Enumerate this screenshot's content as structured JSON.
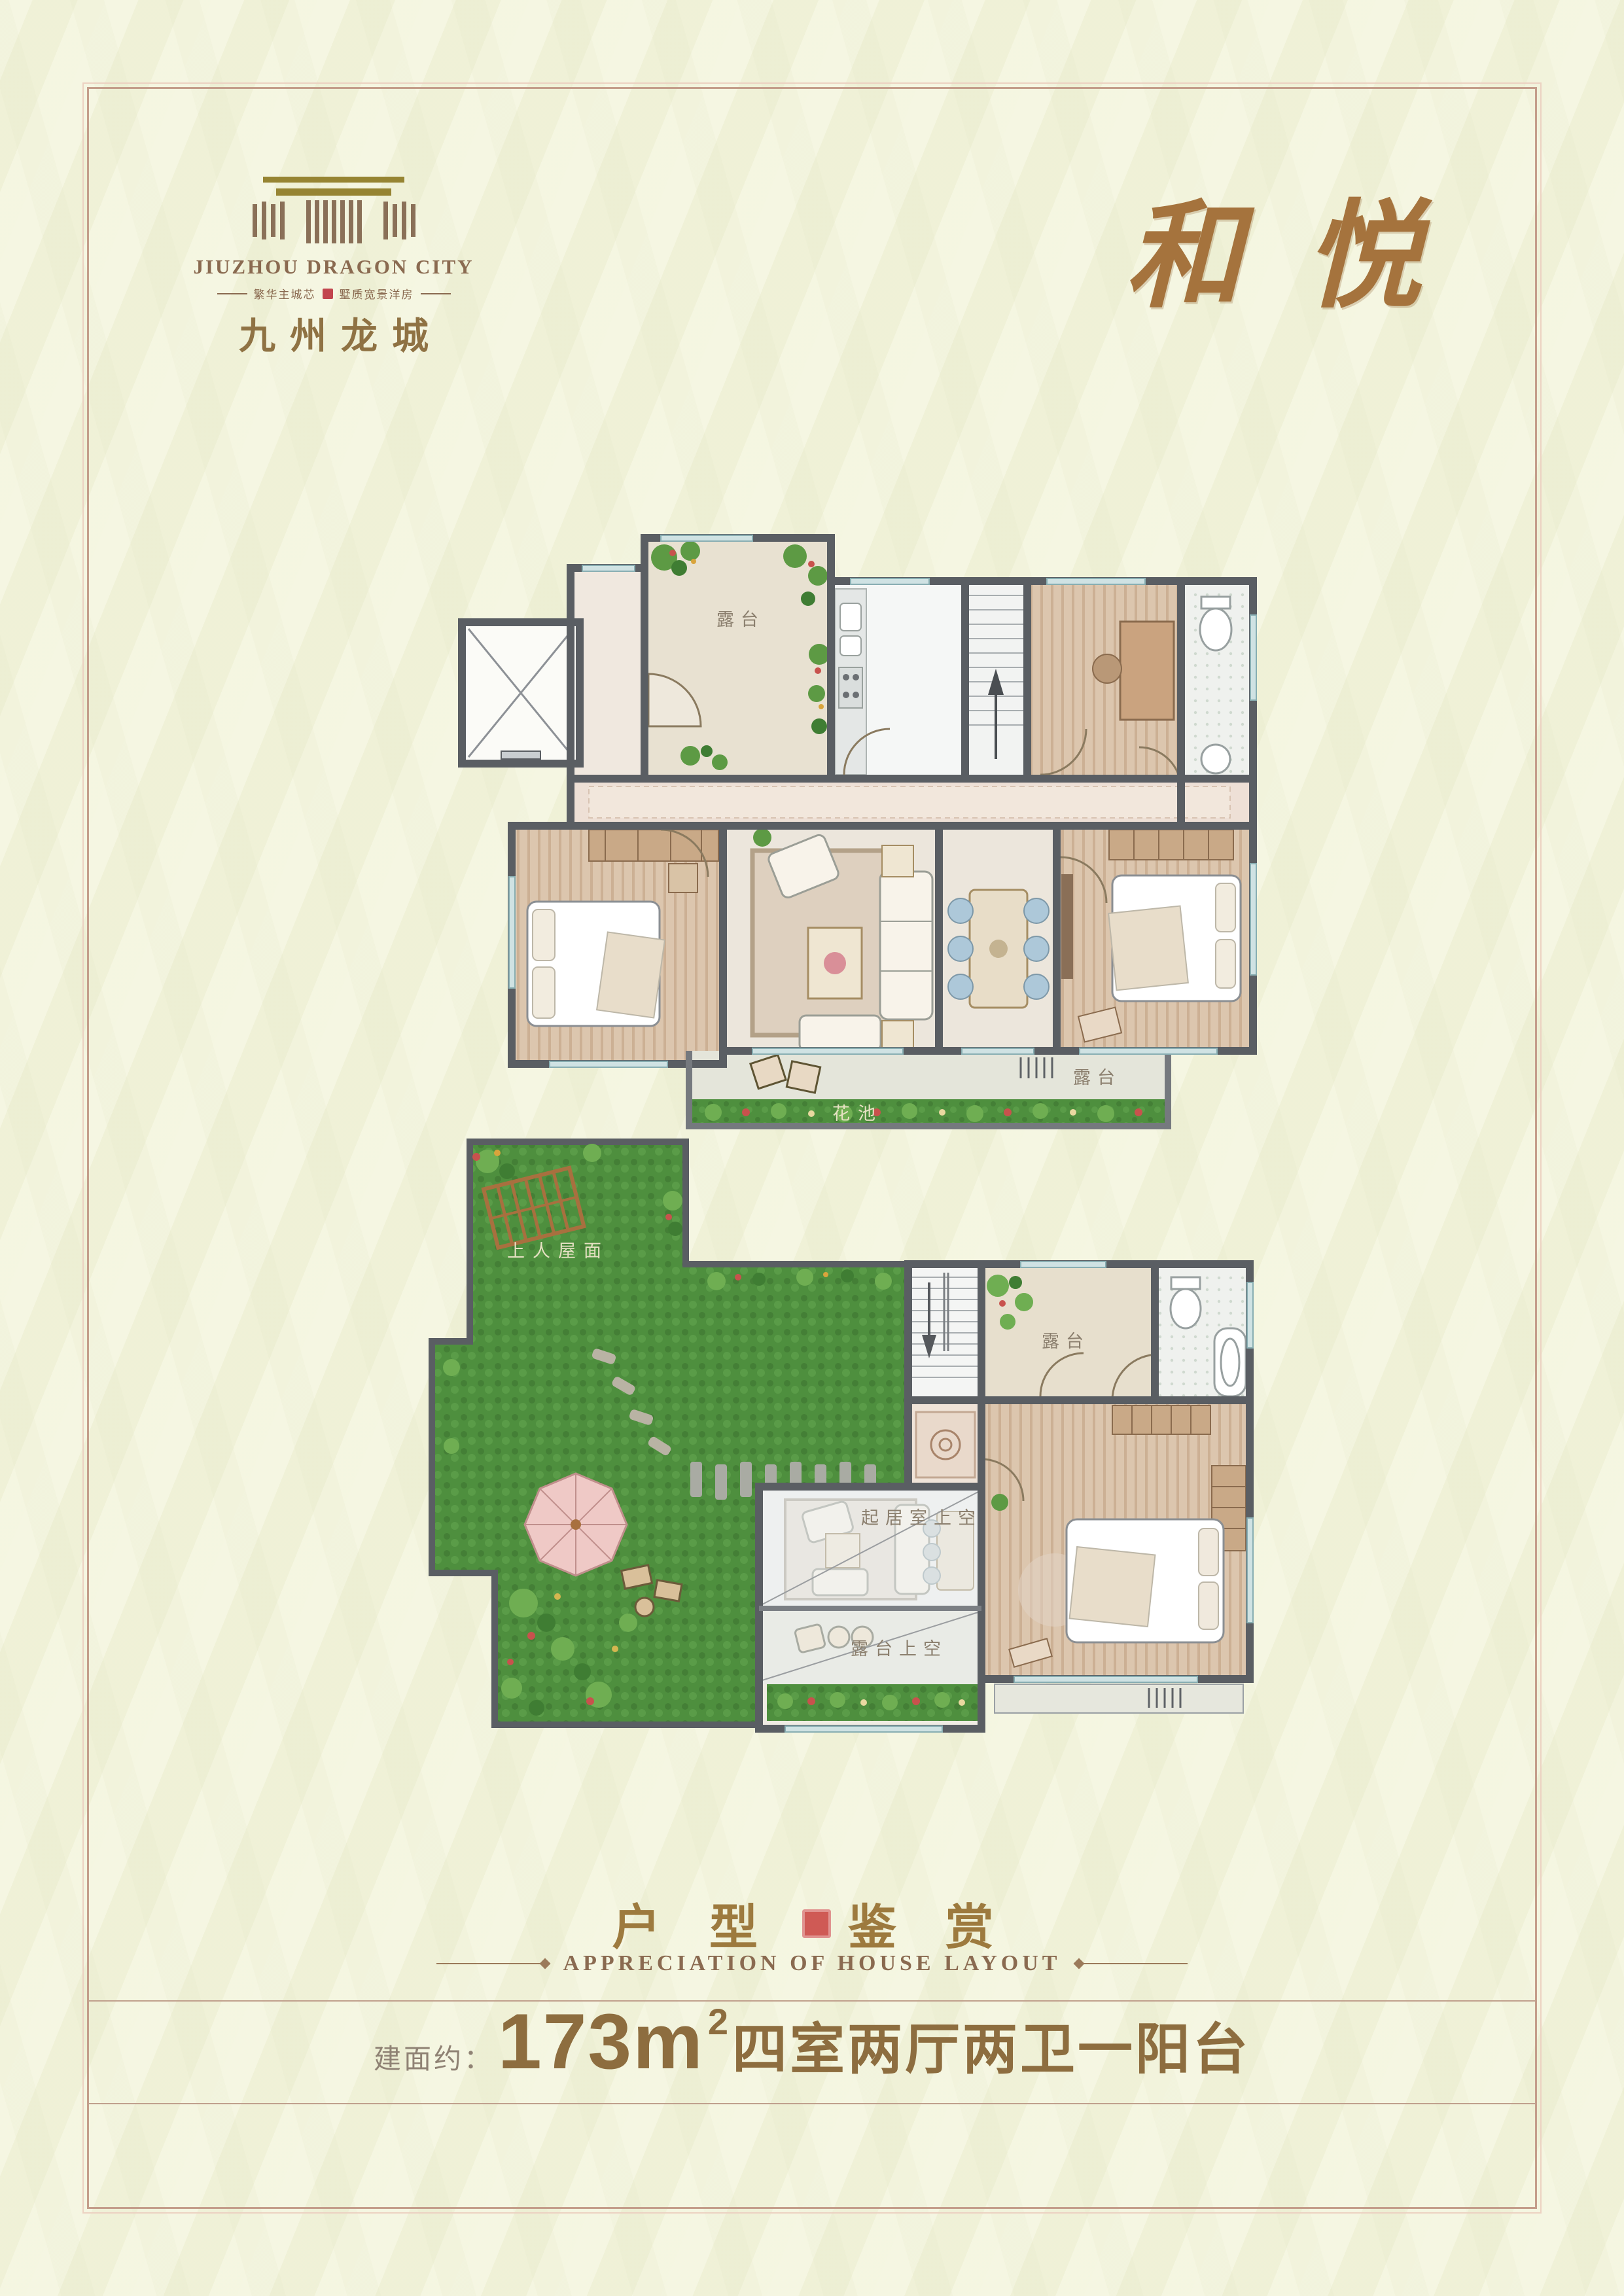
{
  "logo": {
    "name_en": "JIUZHOU DRAGON CITY",
    "tagline_left": "繁华主城芯",
    "tagline_right": "墅质宽景洋房",
    "name_cn": "九州龙城"
  },
  "title": {
    "calligraphy": "和悦"
  },
  "plans": {
    "upper": {
      "labels": {
        "terrace_top": "露台",
        "terrace_bottom": "露台",
        "flower_bed": "花池"
      }
    },
    "lower": {
      "labels": {
        "roof_garden": "上人屋面",
        "terrace": "露台",
        "living_void": "起居室上空",
        "terrace_void": "露台上空"
      }
    }
  },
  "section": {
    "title_left": "户 型",
    "title_right": "鉴 赏",
    "subtitle": "APPRECIATION  OF  HOUSE  LAYOUT"
  },
  "spec": {
    "prefix": "建面约：",
    "area": "173m",
    "area_exp": "2",
    "layout": "四室两厅两卫一阳台"
  },
  "colors": {
    "background": "#f3f4dc",
    "frame": "#c49e8b",
    "gold_text": "#8d6d3f",
    "brand_brown": "#8a6a50",
    "wall": "#5a5e63",
    "grass": "#4e8f3e",
    "window_blue": "#cfe2e3",
    "seal_red": "#cf5a55"
  }
}
